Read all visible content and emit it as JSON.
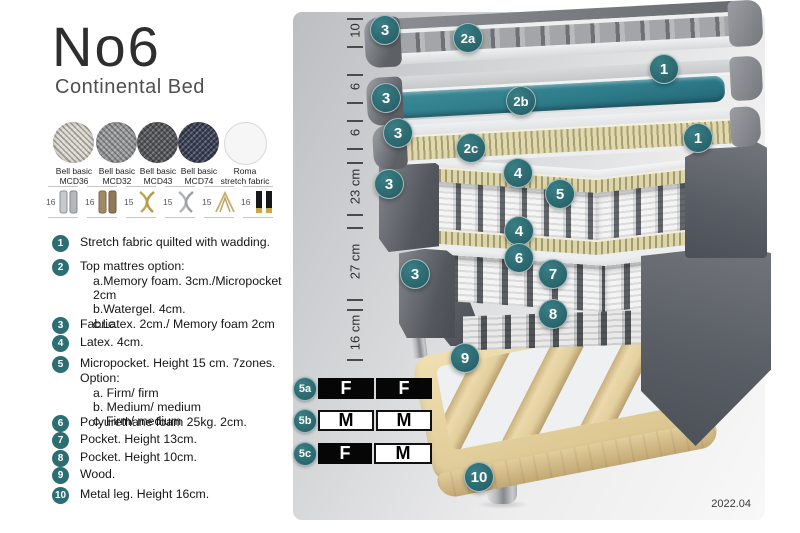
{
  "header": {
    "title": "No6",
    "subtitle": "Continental Bed"
  },
  "page": {
    "version": "2022.04"
  },
  "fabrics": [
    {
      "line1": "Bell basic",
      "line2": "MCD36",
      "color": "#ddd9d0"
    },
    {
      "line1": "Bell basic",
      "line2": "MCD32",
      "color": "#9b9c9e"
    },
    {
      "line1": "Bell basic",
      "line2": "MCD43",
      "color": "#55575a"
    },
    {
      "line1": "Bell basic",
      "line2": "MCD74",
      "color": "#3a4056"
    },
    {
      "line1": "Roma",
      "line2": "stretch fabric",
      "color": "#f5f5f5"
    }
  ],
  "leg_options": [
    {
      "height": "16",
      "type": "cylinder-silver"
    },
    {
      "height": "16",
      "type": "cylinder-bronze"
    },
    {
      "height": "15",
      "type": "twist-gold"
    },
    {
      "height": "15",
      "type": "twist-silver"
    },
    {
      "height": "15",
      "type": "hairpin-gold"
    },
    {
      "height": "16",
      "type": "square-black-gold"
    }
  ],
  "features": [
    {
      "num": "1",
      "text": "Stretch fabric quilted with wadding."
    },
    {
      "num": "2",
      "text": "Top mattres option:",
      "sub": [
        "a.Memory foam. 3cm./Micropocket 2cm",
        "b.Watergel. 4cm.",
        "c.Latex. 2cm./ Memory foam 2cm"
      ]
    },
    {
      "num": "3",
      "text": "Fabric."
    },
    {
      "num": "4",
      "text": "Latex. 4cm."
    },
    {
      "num": "5",
      "text": "Micropocket. Height 15 cm. 7zones. Option:",
      "sub": [
        "a. Firm/ firm",
        "b. Medium/ medium",
        "c. Firm/ medium"
      ]
    },
    {
      "num": "6",
      "text": "Polyurethane foam 25kg. 2cm."
    },
    {
      "num": "7",
      "text": "Pocket. Height 13cm."
    },
    {
      "num": "8",
      "text": "Pocket. Height 10cm."
    },
    {
      "num": "9",
      "text": "Wood."
    },
    {
      "num": "10",
      "text": "Metal leg. Height 16cm."
    }
  ],
  "diagram": {
    "dimensions": [
      "10",
      "6",
      "6",
      "23 cm",
      "27 cm",
      "16 cm"
    ],
    "callouts": {
      "c1": "1",
      "c2a": "2a",
      "c2b": "2b",
      "c2c": "2c",
      "c3": "3",
      "c4": "4",
      "c5": "5",
      "c6": "6",
      "c7": "7",
      "c8": "8",
      "c9": "9",
      "c10": "10"
    },
    "firmness": [
      {
        "id": "5a",
        "left": "F",
        "right": "F"
      },
      {
        "id": "5b",
        "left": "M",
        "right": "M"
      },
      {
        "id": "5c",
        "left": "F",
        "right": "M"
      }
    ],
    "colors": {
      "accent_teal": "#2d6e73",
      "layer_teal": "#2e7b8a",
      "fabric_dark": "#575b62",
      "wood": "#e9d6a9"
    }
  }
}
